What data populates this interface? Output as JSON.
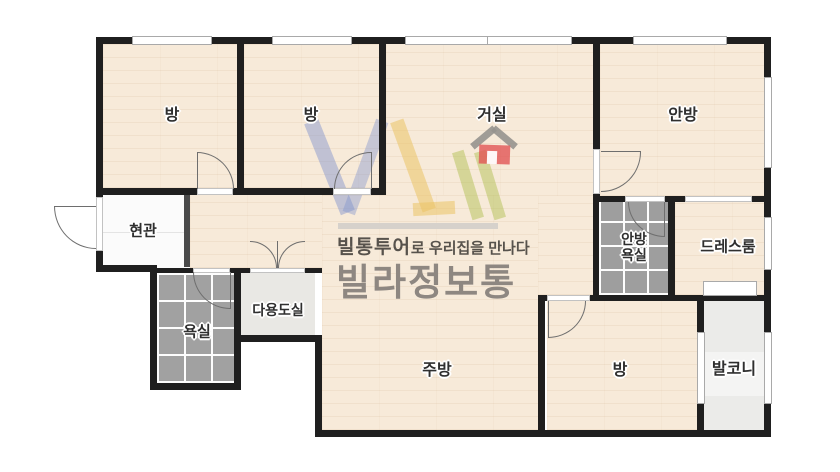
{
  "watermark": {
    "tagline_brand": "빌통투어",
    "tagline_rest": "로 우리집을 만나다",
    "brand": "빌라정보통"
  },
  "rooms": {
    "bedroom1": "방",
    "bedroom2": "방",
    "living": "거실",
    "master": "안방",
    "entrance": "현관",
    "master_bath_line1": "안방",
    "master_bath_line2": "욕실",
    "dressroom": "드레스룸",
    "bathroom": "욕실",
    "utility": "다용도실",
    "kitchen": "주방",
    "bedroom3": "방",
    "balcony": "발코니"
  },
  "colors": {
    "wall": "#1f1f1f",
    "wood_floor": "#f7ead9",
    "tile_floor": "#a1a1a1",
    "entrance_floor": "#fbfbfb",
    "utility_floor": "#e9e8e4",
    "balcony_floor": "#ebebe9",
    "watermark_text": "#8e8781",
    "logo_blue": "#7d91cd",
    "logo_yellow": "#ebc364",
    "logo_green": "#afbe50",
    "logo_red": "#e15555"
  }
}
